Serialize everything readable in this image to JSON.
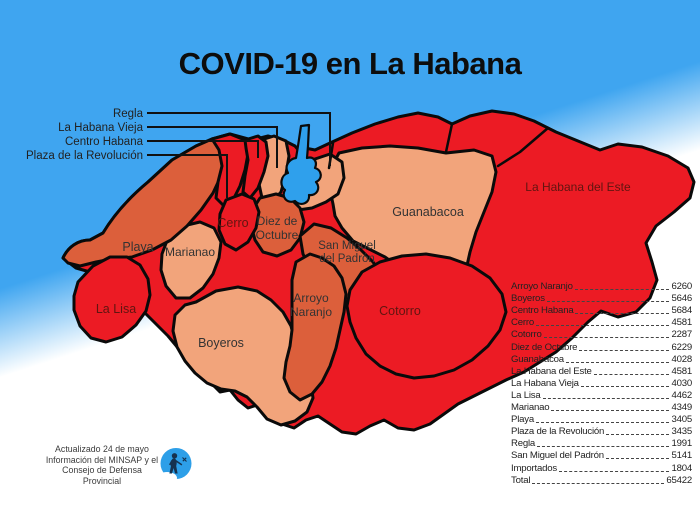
{
  "title": "COVID-19 en La Habana",
  "callouts": {
    "items": [
      {
        "label": "Regla"
      },
      {
        "label": "La Habana Vieja"
      },
      {
        "label": "Centro Habana"
      },
      {
        "label": "Plaza de la Revolución"
      }
    ]
  },
  "map": {
    "labels": {
      "playa": "Playa",
      "marianao": "Marianao",
      "la_lisa": "La Lisa",
      "cerro": "Cerro",
      "diez_1": "Diez de",
      "diez_2": "Octubre",
      "smp_1": "San Miguel",
      "smp_2": "del Padrón",
      "arroyo_1": "Arroyo",
      "arroyo_2": "Naranjo",
      "boyeros": "Boyeros",
      "guanabacoa": "Guanabacoa",
      "cotorro": "Cotorro",
      "habana_este": "La Habana del Este"
    }
  },
  "table": {
    "rows": [
      {
        "name": "Arroyo Naranjo",
        "value": "6260"
      },
      {
        "name": "Boyeros",
        "value": "5646"
      },
      {
        "name": "Centro Habana",
        "value": "5684"
      },
      {
        "name": "Cerro",
        "value": "4581"
      },
      {
        "name": "Cotorro",
        "value": "2287"
      },
      {
        "name": "Diez de Octubre",
        "value": "6229"
      },
      {
        "name": "Guanabacoa",
        "value": "4028"
      },
      {
        "name": "La Habana del Este",
        "value": "4581"
      },
      {
        "name": "La Habana Vieja",
        "value": "4030"
      },
      {
        "name": "La Lisa",
        "value": "4462"
      },
      {
        "name": "Marianao",
        "value": "4349"
      },
      {
        "name": "Playa",
        "value": "3405"
      },
      {
        "name": "Plaza de la Revolución",
        "value": "3435"
      },
      {
        "name": "Regla",
        "value": "1991"
      },
      {
        "name": "San Miguel del Padrón",
        "value": "5141"
      },
      {
        "name": "Importados",
        "value": "1804"
      },
      {
        "name": "Total",
        "value": "65422"
      }
    ]
  },
  "footer": {
    "lines": [
      "Actualizado 24 de mayo",
      "Información del MINSAP y el",
      "Consejo de Defensa Provincial"
    ]
  },
  "colors": {
    "sea_blue": "#3fa5f0",
    "region_red": "#ec1b24",
    "region_orange": "#dc5f3b",
    "region_salmon": "#f2a47b",
    "bay_blue": "#2fa0ec",
    "outline_black": "#0a0a0a"
  }
}
